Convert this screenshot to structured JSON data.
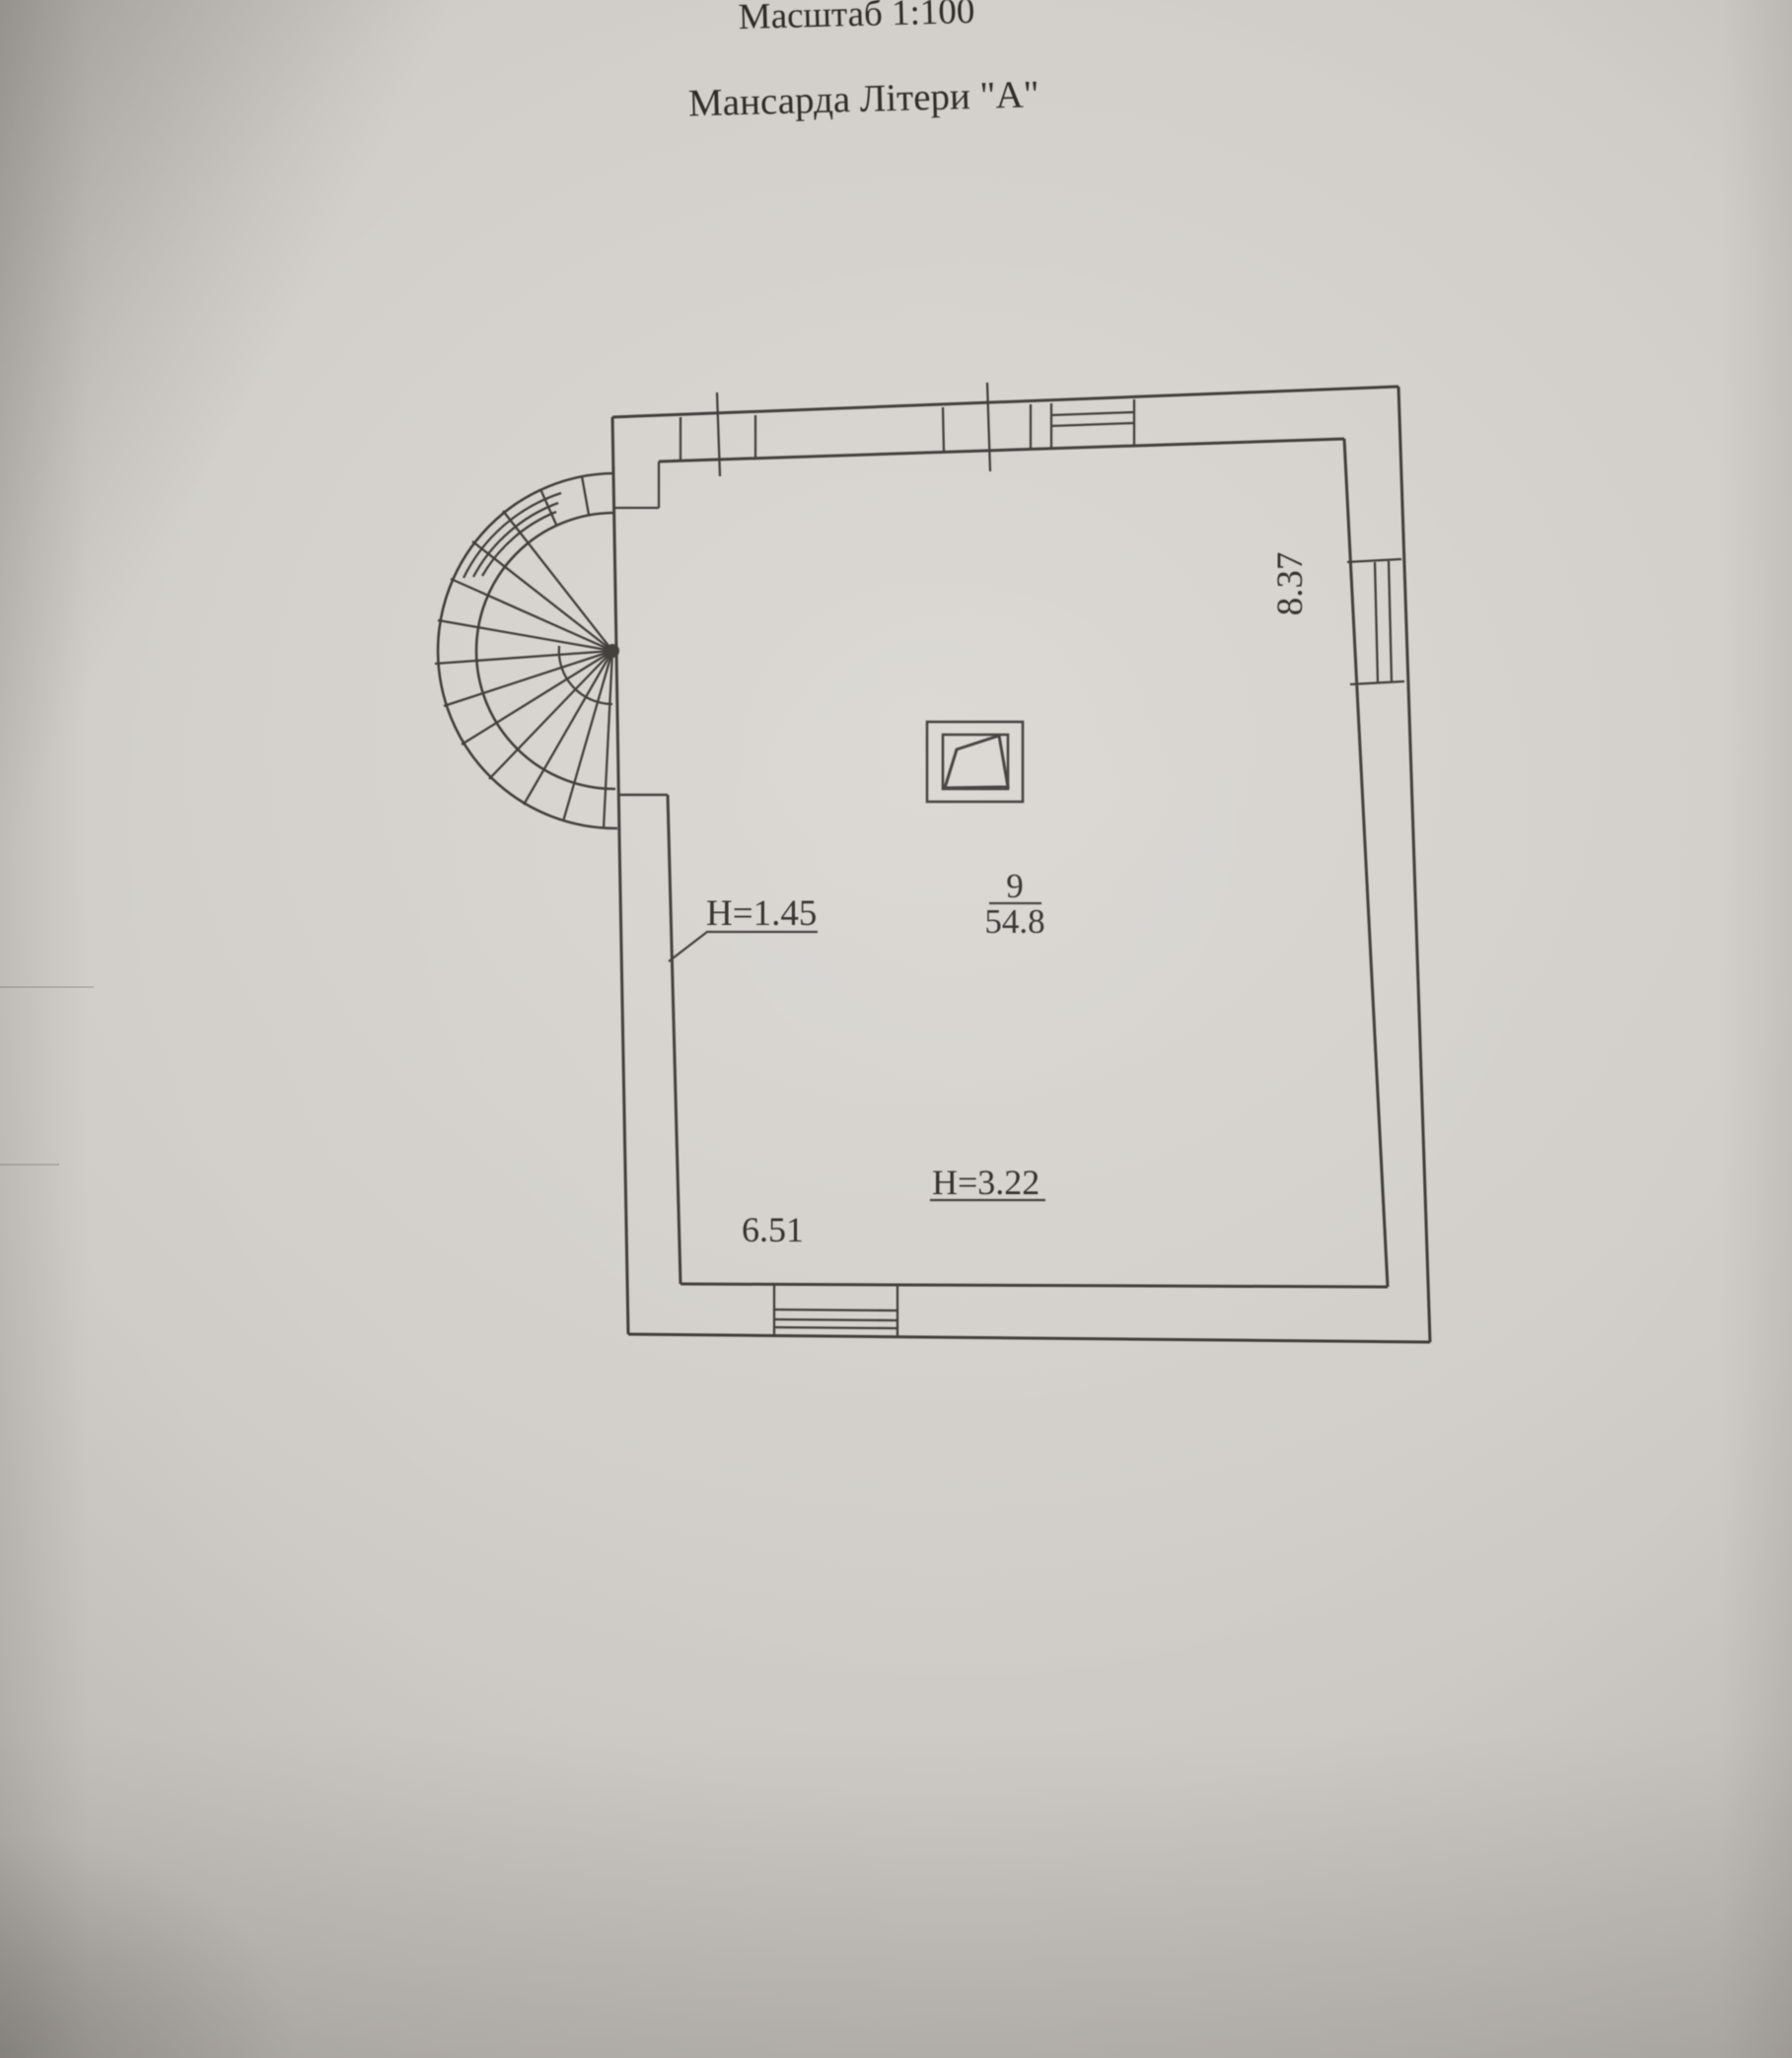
{
  "document": {
    "scale_title": "Масштаб 1:100",
    "drawing_title": "Мансарда Літери \"А\""
  },
  "plan": {
    "room_number": "9",
    "room_area": "54.8",
    "height_low": "H=1.45",
    "height_high": "H=3.22",
    "dim_width": "6.51",
    "dim_depth": "8.37"
  },
  "colors": {
    "paper": "#cfccc7",
    "ink": "#3a3734",
    "text": "#2b2925"
  }
}
